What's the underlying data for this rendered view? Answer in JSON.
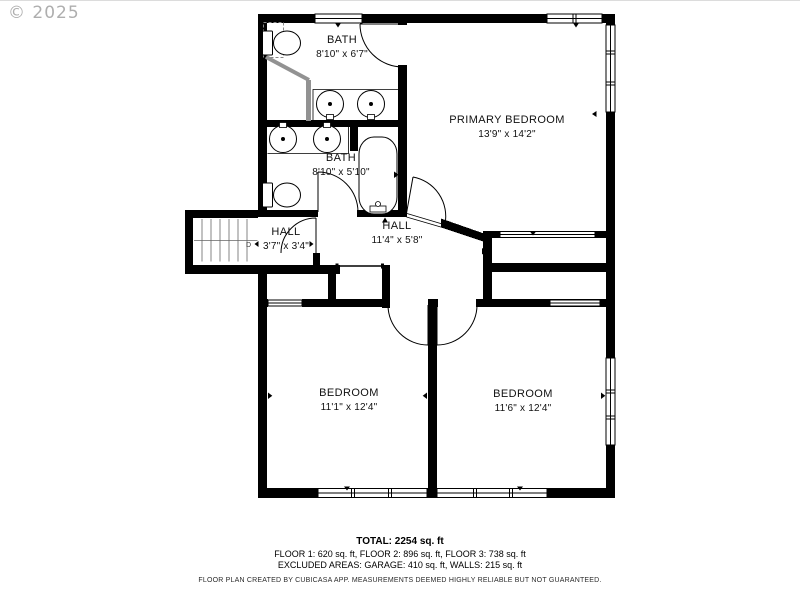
{
  "watermark": "© 2025",
  "rooms": [
    {
      "id": "bath-top",
      "name": "BATH",
      "dims": "8'10\" x 6'7\""
    },
    {
      "id": "primary-bedroom",
      "name": "PRIMARY BEDROOM",
      "dims": "13'9\" x 14'2\""
    },
    {
      "id": "bath-middle",
      "name": "BATH",
      "dims": "8'10\" x 5'10\""
    },
    {
      "id": "hall-left",
      "name": "HALL",
      "dims": "3'7\" x 3'4\""
    },
    {
      "id": "hall-center",
      "name": "HALL",
      "dims": "11'4\" x 5'8\""
    },
    {
      "id": "bedroom-left",
      "name": "BEDROOM",
      "dims": "11'1\" x 12'4\""
    },
    {
      "id": "bedroom-right",
      "name": "BEDROOM",
      "dims": "11'6\" x 12'4\""
    }
  ],
  "stairs": {
    "direction_label": "D"
  },
  "summary": {
    "total": "TOTAL: 2254 sq. ft",
    "floors": "FLOOR 1: 620 sq. ft, FLOOR 2: 896 sq. ft, FLOOR 3: 738 sq. ft",
    "excluded": "EXCLUDED AREAS: GARAGE: 410 sq. ft, WALLS: 215 sq. ft",
    "disclaimer": "FLOOR PLAN CREATED BY CUBICASA APP. MEASUREMENTS DEEMED HIGHLY RELIABLE BUT NOT GUARANTEED."
  },
  "colors": {
    "wall": "#000000",
    "shower": "#929292",
    "watermark": "#9a9a9a"
  }
}
